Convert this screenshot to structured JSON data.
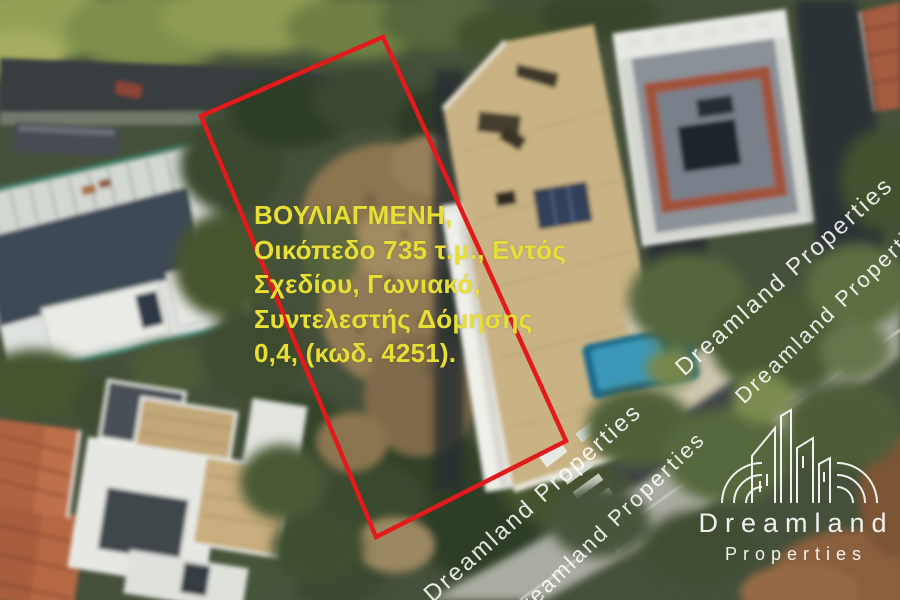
{
  "image_type": "aerial-satellite-listing-photo",
  "listing": {
    "location": "ΒΟΥΛΙΑΓΜΕΝΗ",
    "lines": [
      "ΒΟΥΛΙΑΓΜΕΝΗ,",
      "Οικόπεδο 735 τ.μ., Εντός",
      "Σχεδίου, Γωνιακό,",
      "Συντελεστής Δόμησης",
      "0,4, (κωδ. 4251)."
    ],
    "plot_area_sqm": "735",
    "building_coefficient": "0,4",
    "listing_code": "4251",
    "text_color": "#e7df35"
  },
  "plot_outline": {
    "points": "383,37 566,441 376,537 201,116",
    "color": "#e31a1c"
  },
  "watermark": {
    "text": "Dreamland Properties",
    "strip_a": "Dreamland Properties      Dreamland Properties",
    "strip_b": "Dreamland Properties      Dreamland Properties",
    "color": "#ffffff"
  },
  "logo": {
    "name": "Dreamland",
    "tagline": "Properties"
  }
}
